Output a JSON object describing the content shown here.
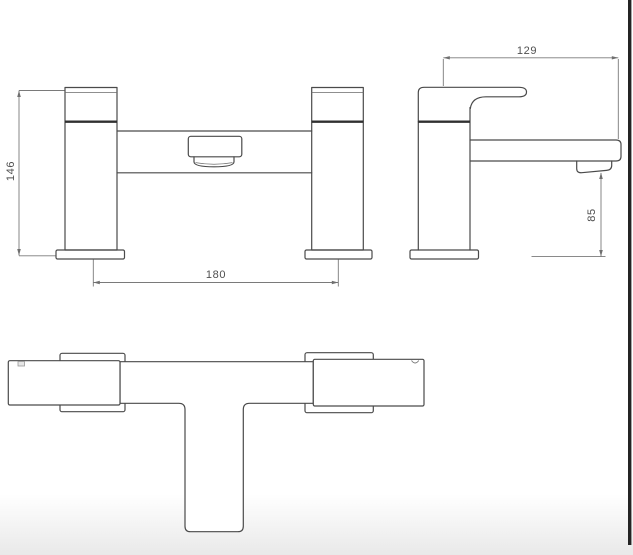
{
  "drawing": {
    "type": "technical-dimension-diagram",
    "subject": "bath filler tap, front / side / plan orthographic views",
    "dimensions": {
      "front_height": "146",
      "front_tap_centers": "180",
      "side_depth": "129",
      "side_spout_height": "85"
    },
    "colors": {
      "object_line": "#4a4a4a",
      "dimension_line": "#7a7a7a",
      "dimension_text": "#4f4f4f",
      "background_top": "#ffffff",
      "background_bottom": "#e9e9e9",
      "right_edge_strip": "#242424"
    }
  }
}
